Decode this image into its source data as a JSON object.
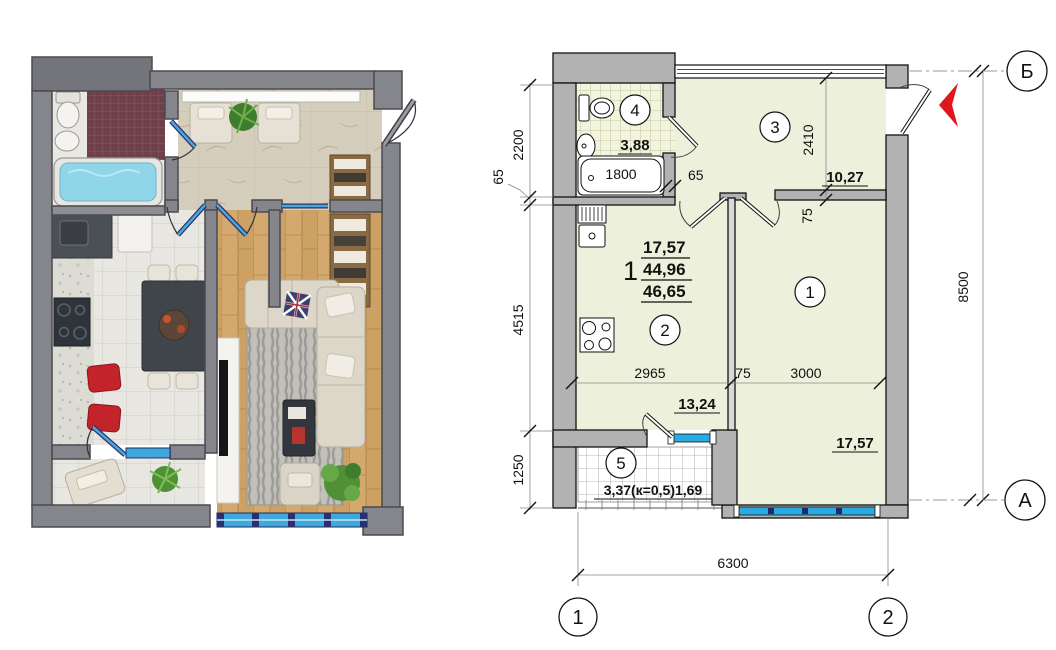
{
  "left_render": {
    "description": "3D rendered apartment floor plan",
    "palette": {
      "wall": "#85858c",
      "wall_dark": "#74747b",
      "marble": "#d6cebc",
      "white_tile": "#e9e7e2",
      "mosaic": "#6e4049",
      "wood": "#d4a96e",
      "water": "#8fd6e8",
      "glass_door": "#4aa8d8",
      "window_blue": "#3fa9dc",
      "red_chair": "#c3242c",
      "sofa": "#dcd7c9",
      "rug": "#b5b3ae",
      "plant": "#4f9134",
      "counter_dark": "#4b5055",
      "table_dark": "#40454c"
    }
  },
  "tech_plan": {
    "palette": {
      "room_fill": "#edf1db",
      "wall_fill": "#b2b2b2",
      "line": "#111111",
      "window_blue": "#29abe2",
      "mullion_navy": "#232a63",
      "arrow_red": "#e0161f"
    },
    "apartment_stamp": {
      "rooms_count": "1",
      "living_area": "17,57",
      "apartment_area": "44,96",
      "total_area": "46,65"
    },
    "rooms": [
      {
        "number": "1",
        "area": "17,57"
      },
      {
        "number": "2",
        "area": "13,24"
      },
      {
        "number": "3",
        "area": "10,27"
      },
      {
        "number": "4",
        "area": "3,88"
      },
      {
        "number": "5",
        "area": "3,37(к=0,5)1,69"
      }
    ],
    "fixtures": {
      "bathtub_length": "1800"
    },
    "dimensions": {
      "left_chain": [
        "2200",
        "65",
        "4515",
        "1250"
      ],
      "right_total": "8500",
      "bottom_total": "6300",
      "bath_wall": "65",
      "hall_depth": "2410",
      "hall_wall": "75",
      "kitchen_width": "2965",
      "mid_wall": "75",
      "room1_width": "3000"
    },
    "axes": {
      "horizontal_top": "Б",
      "horizontal_bottom": "А",
      "vertical_left": "1",
      "vertical_right": "2"
    }
  }
}
